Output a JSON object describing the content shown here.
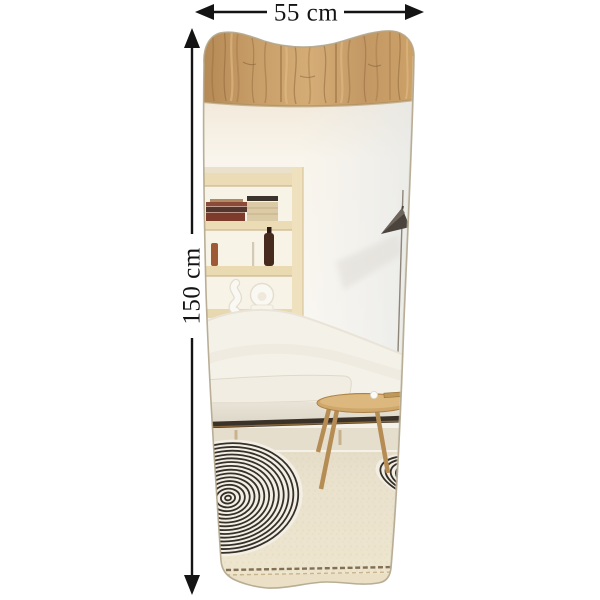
{
  "annotations": {
    "width_label": "55 cm",
    "height_label": "150 cm"
  },
  "icons": {
    "width_arrow": "double-headed-horizontal-arrow",
    "height_arrow": "double-headed-vertical-arrow"
  },
  "colors": {
    "annotation": "#141414",
    "background": "#ffffff",
    "wood_ceiling": "#c99f69",
    "wall": "#f8f5ee",
    "shelf_wood": "#ecdcb5",
    "lamp_shade": "#4b443d",
    "sofa": "#f4f1e9",
    "sofa_rail": "#3a3128",
    "table_wood": "#cfa76b",
    "rug_stripe": "#35302a",
    "carpet": "#e9e1cc",
    "mirror_edge": "#b3a68c"
  }
}
